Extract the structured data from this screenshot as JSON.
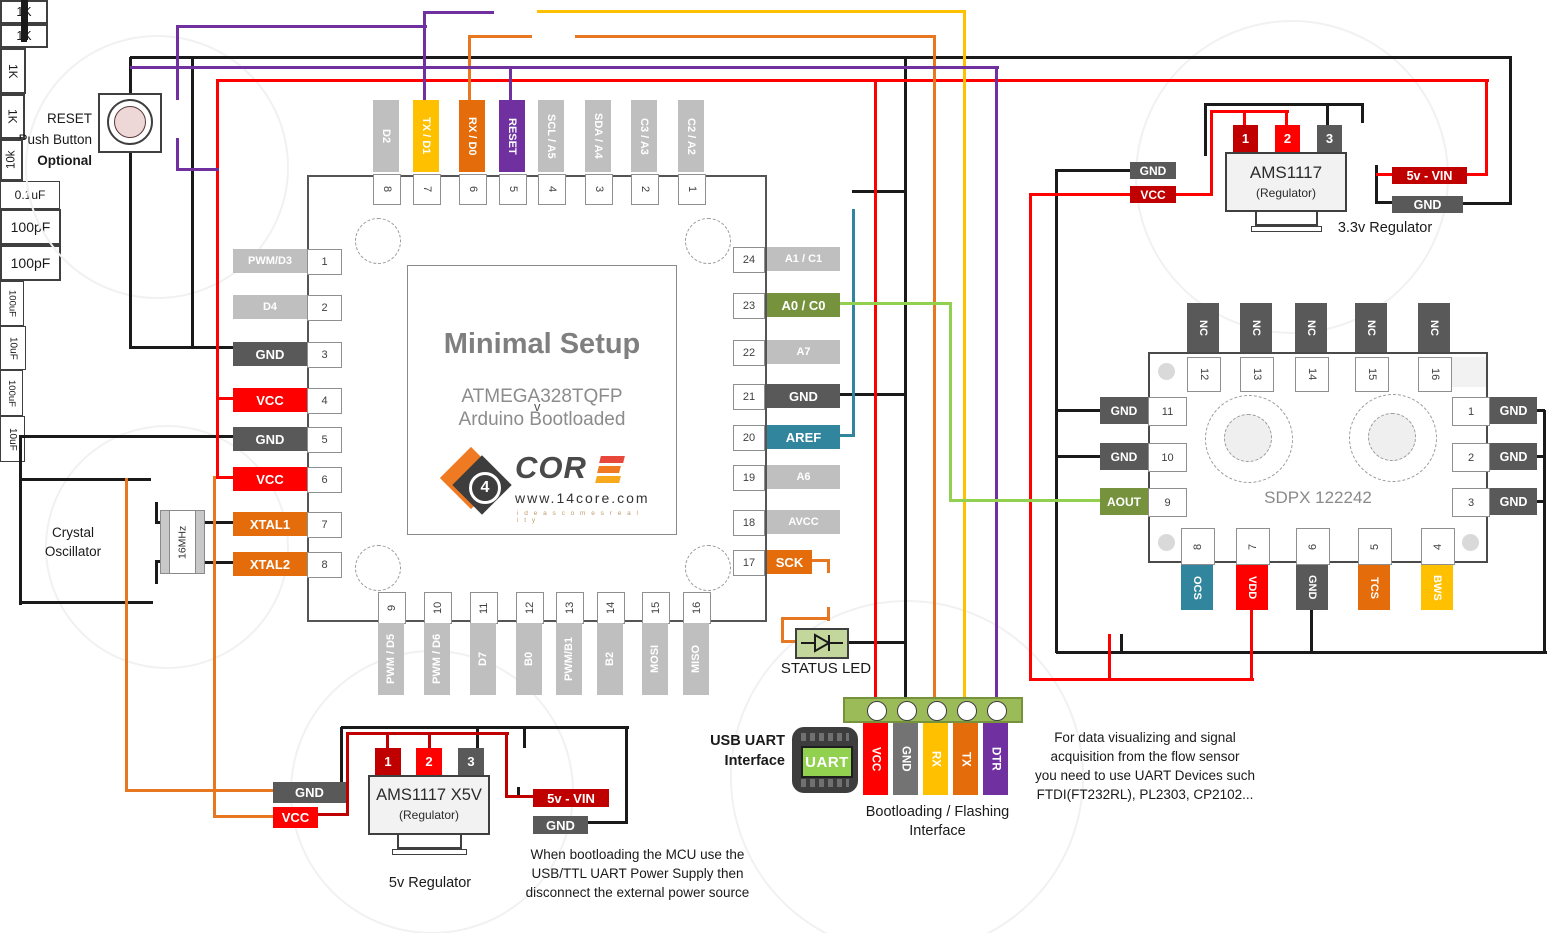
{
  "palette": {
    "wire_black": "#1a1a1a",
    "wire_red": "#ff0000",
    "wire_darkred": "#c00000",
    "wire_orange": "#e87722",
    "wire_yellow": "#ffc000",
    "wire_purple": "#7030a0",
    "wire_teal": "#31859c",
    "wire_green": "#92d050",
    "pin_gray": "#bfbfbf",
    "pin_dark": "#595959",
    "pin_red": "#ff0000",
    "pin_darkred": "#c00000",
    "pin_orange": "#e46c0a",
    "pin_amber": "#ffc000",
    "pin_purple": "#7030a0",
    "pin_teal": "#31859c",
    "pin_olive": "#76923c",
    "pin_midgray": "#737373",
    "header_green": "#9bbb59",
    "led_green": "#c3d69b",
    "uart_screen": "#92d050",
    "body_gray": "#f2f2f2"
  },
  "reset_block": {
    "line1": "RESET",
    "line2": "Push Button",
    "line3": "Optional"
  },
  "crystal": {
    "freq": "16MHz",
    "label1": "Crystal",
    "label2": "Oscillator",
    "cap_top": "100pF",
    "cap_bottom": "100pF"
  },
  "resistors": {
    "top1": "1K",
    "top2": "1K",
    "button": "1K",
    "mid": "1K",
    "led": "10k"
  },
  "caps": {
    "aref": "0.1uF",
    "sensor": "100nF"
  },
  "mcu": {
    "title": "Minimal Setup",
    "chip": "ATMEGA328TQFP",
    "artifact": "v",
    "sub": "Arduino Bootloaded",
    "logo": {
      "num": "4",
      "word": "COR",
      "site": "www.14core.com",
      "tag": "i d e a s   c o m e s   r e a l i t y"
    },
    "top_pins": [
      {
        "label": "D2",
        "num": "8",
        "color": "pin_gray"
      },
      {
        "label": "TX / D1",
        "num": "7",
        "color": "pin_amber"
      },
      {
        "label": "RX / D0",
        "num": "6",
        "color": "pin_orange"
      },
      {
        "label": "RESET",
        "num": "5",
        "color": "pin_purple"
      },
      {
        "label": "SCL / A5",
        "num": "4",
        "color": "pin_gray"
      },
      {
        "label": "SDA / A4",
        "num": "3",
        "color": "pin_gray"
      },
      {
        "label": "C3 / A3",
        "num": "2",
        "color": "pin_gray"
      },
      {
        "label": "C2 / A2",
        "num": "1",
        "color": "pin_gray"
      }
    ],
    "left_pins": [
      {
        "label": "PWM/D3",
        "num": "1",
        "color": "pin_gray"
      },
      {
        "label": "D4",
        "num": "2",
        "color": "pin_gray"
      },
      {
        "label": "GND",
        "num": "3",
        "color": "pin_dark"
      },
      {
        "label": "VCC",
        "num": "4",
        "color": "pin_red"
      },
      {
        "label": "GND",
        "num": "5",
        "color": "pin_dark"
      },
      {
        "label": "VCC",
        "num": "6",
        "color": "pin_red"
      },
      {
        "label": "XTAL1",
        "num": "7",
        "color": "pin_orange"
      },
      {
        "label": "XTAL2",
        "num": "8",
        "color": "pin_orange"
      }
    ],
    "right_pins": [
      {
        "label": "A1 / C1",
        "num": "24",
        "color": "pin_gray"
      },
      {
        "label": "A0 / C0",
        "num": "23",
        "color": "pin_olive"
      },
      {
        "label": "A7",
        "num": "22",
        "color": "pin_gray"
      },
      {
        "label": "GND",
        "num": "21",
        "color": "pin_dark"
      },
      {
        "label": "AREF",
        "num": "20",
        "color": "pin_teal"
      },
      {
        "label": "A6",
        "num": "19",
        "color": "pin_gray"
      },
      {
        "label": "AVCC",
        "num": "18",
        "color": "pin_gray"
      },
      {
        "label": "SCK",
        "num": "17",
        "color": "pin_orange"
      }
    ],
    "bottom_pins": [
      {
        "label": "PWM / D5",
        "num": "9",
        "color": "pin_gray"
      },
      {
        "label": "PWM / D6",
        "num": "10",
        "color": "pin_gray"
      },
      {
        "label": "D7",
        "num": "11",
        "color": "pin_gray"
      },
      {
        "label": "B0",
        "num": "12",
        "color": "pin_gray"
      },
      {
        "label": "PWM/B1",
        "num": "13",
        "color": "pin_gray"
      },
      {
        "label": "B2",
        "num": "14",
        "color": "pin_gray"
      },
      {
        "label": "MOSI",
        "num": "15",
        "color": "pin_gray"
      },
      {
        "label": "MISO",
        "num": "16",
        "color": "pin_gray"
      }
    ]
  },
  "reg5": {
    "name": "AMS1117 X5V",
    "sub": "(Regulator)",
    "pin1": "1",
    "pin2": "2",
    "pin3": "3",
    "gnd": "GND",
    "vcc": "VCC",
    "cin": "100uF",
    "cout": "10uF",
    "vin": "5v - VIN",
    "gnd2": "GND",
    "caption": "5v Regulator"
  },
  "reg33": {
    "name": "AMS1117",
    "sub": "(Regulator)",
    "pin1": "1",
    "pin2": "2",
    "pin3": "3",
    "gnd": "GND",
    "vcc": "VCC",
    "cin": "100uF",
    "cout": "10uF",
    "vin": "5v - VIN",
    "gnd2": "GND",
    "caption": "3.3v Regulator"
  },
  "sensor": {
    "name": "SDPX  122242",
    "top_pins": [
      {
        "label": "NC",
        "num": "12"
      },
      {
        "label": "NC",
        "num": "13"
      },
      {
        "label": "NC",
        "num": "14"
      },
      {
        "label": "NC",
        "num": "15"
      },
      {
        "label": "NC",
        "num": "16"
      }
    ],
    "left_pins": [
      {
        "num": "11",
        "label": "GND",
        "color": "pin_dark"
      },
      {
        "num": "10",
        "label": "GND",
        "color": "pin_dark"
      },
      {
        "num": "9",
        "label": "AOUT",
        "color": "pin_olive"
      }
    ],
    "right_pins": [
      {
        "num": "1",
        "label": "GND",
        "color": "pin_dark"
      },
      {
        "num": "2",
        "label": "GND",
        "color": "pin_dark"
      },
      {
        "num": "3",
        "label": "GND",
        "color": "pin_dark"
      }
    ],
    "bottom_pins": [
      {
        "num": "8",
        "label": "OCS",
        "color": "pin_teal"
      },
      {
        "num": "7",
        "label": "VDD",
        "color": "pin_red"
      },
      {
        "num": "6",
        "label": "GND",
        "color": "pin_dark"
      },
      {
        "num": "5",
        "label": "TCS",
        "color": "pin_orange"
      },
      {
        "num": "4",
        "label": "BWS",
        "color": "pin_amber"
      }
    ]
  },
  "uart": {
    "title1": "USB UART",
    "title2": "Interface",
    "chip": "UART",
    "pins": [
      {
        "label": "VCC",
        "color": "pin_red"
      },
      {
        "label": "GND",
        "color": "pin_midgray"
      },
      {
        "label": "RX",
        "color": "pin_amber"
      },
      {
        "label": "TX",
        "color": "pin_orange"
      },
      {
        "label": "DTR",
        "color": "pin_purple"
      }
    ],
    "caption1": "Bootloading / Flashing",
    "caption2": "Interface"
  },
  "status_led": "STATUS LED",
  "notes": {
    "uart_note": [
      "For data visualizing and signal",
      "acquisition  from the flow sensor",
      "you need to use UART Devices such",
      "FTDI(FT232RL), PL2303, CP2102..."
    ],
    "bootload_note": [
      "When bootloading the MCU use the",
      "USB/TTL UART Power Supply then",
      "disconnect the external power source"
    ]
  }
}
